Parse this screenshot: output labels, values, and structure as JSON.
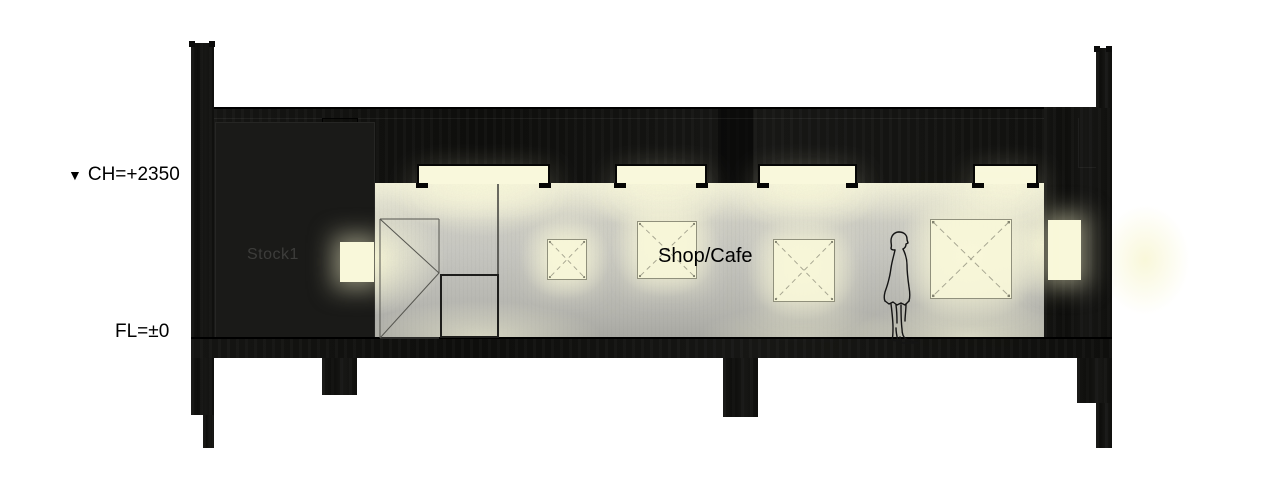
{
  "drawing": {
    "kind": "architectural cross-section",
    "annotations": {
      "ceiling_marker": "▼",
      "ceiling_label": "CH=+2350",
      "floor_label": "FL=±0"
    },
    "rooms": {
      "stock": "Stock1",
      "shop": "Shop/Cafe"
    },
    "fixtures": {
      "ceiling_light_count": 4,
      "wall_panel_count": 4,
      "niche_count": 2,
      "person_icon": "standing-person"
    },
    "colors": {
      "structure": "#131311",
      "light_cream": "#f9f8dc",
      "wall_concrete": "#c7c7c1",
      "background": "#ffffff",
      "stock_text": "#3d3d3b"
    }
  }
}
